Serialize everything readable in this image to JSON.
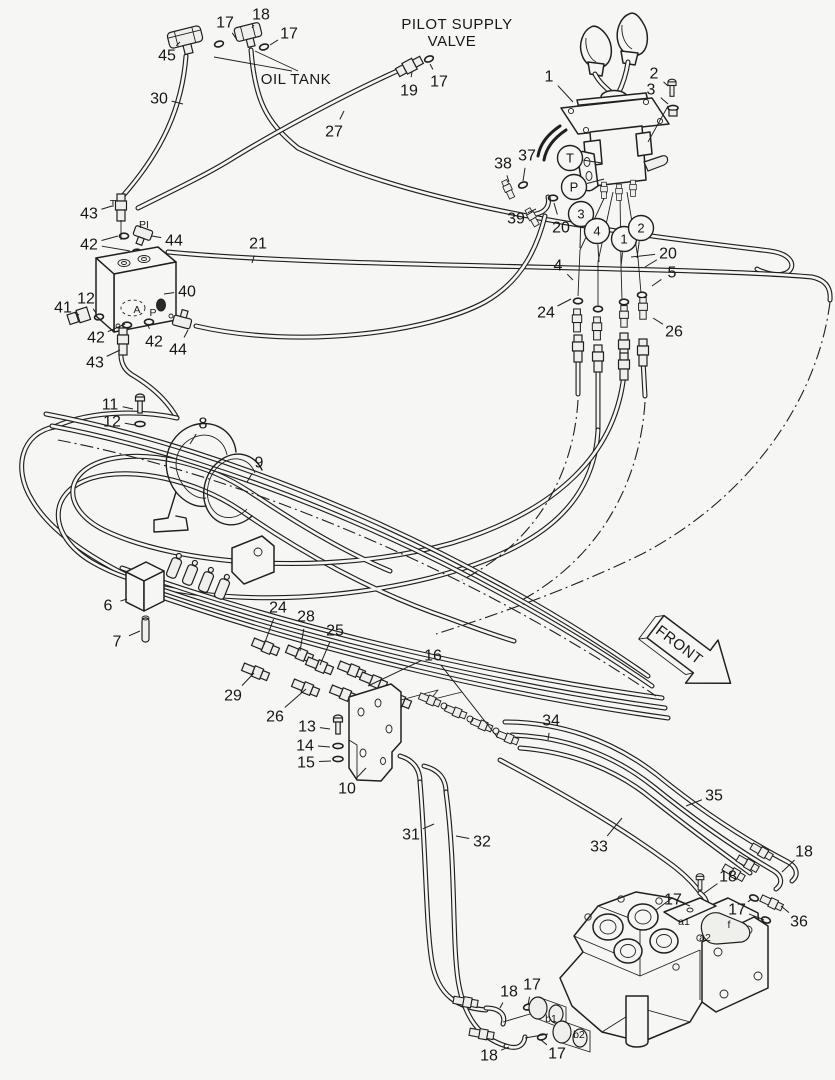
{
  "diagram": {
    "type": "parts-piping-diagram",
    "subject": "Pilot supply valve hose / piping assembly",
    "colors": {
      "line": "#202020",
      "background": "#f6f6f4"
    },
    "labels": {
      "pilot_supply_valve_line1": "PILOT SUPPLY",
      "pilot_supply_valve_line2": "VALVE",
      "oil_tank": "OIL TANK",
      "front": "FRONT"
    },
    "callouts": [
      {
        "t": "17",
        "x": 225,
        "y": 22,
        "lx": 237,
        "ly": 40
      },
      {
        "t": "18",
        "x": 261,
        "y": 14,
        "lx": 252,
        "ly": 28
      },
      {
        "t": "17",
        "x": 289,
        "y": 33,
        "lx": 270,
        "ly": 45
      },
      {
        "t": "45",
        "x": 167,
        "y": 55,
        "lx": 180,
        "ly": 42
      },
      {
        "t": "30",
        "x": 159,
        "y": 98,
        "lx": 183,
        "ly": 104
      },
      {
        "t": "27",
        "x": 334,
        "y": 131,
        "lx": 344,
        "ly": 111
      },
      {
        "t": "19",
        "x": 409,
        "y": 90,
        "lx": 412,
        "ly": 72
      },
      {
        "t": "17",
        "x": 439,
        "y": 81,
        "lx": 430,
        "ly": 64
      },
      {
        "t": "1",
        "x": 549,
        "y": 76,
        "lx": 573,
        "ly": 102
      },
      {
        "t": "2",
        "x": 654,
        "y": 73,
        "lx": 668,
        "ly": 86
      },
      {
        "t": "3",
        "x": 651,
        "y": 89,
        "lx": 668,
        "ly": 104
      },
      {
        "t": "38",
        "x": 503,
        "y": 163,
        "lx": 509,
        "ly": 182
      },
      {
        "t": "37",
        "x": 527,
        "y": 155,
        "lx": 523,
        "ly": 181
      },
      {
        "t": "39",
        "x": 516,
        "y": 218,
        "lx": 536,
        "ly": 209
      },
      {
        "t": "20",
        "x": 561,
        "y": 227,
        "lx": 554,
        "ly": 203
      },
      {
        "t": "20",
        "x": 668,
        "y": 253,
        "lx": 631,
        "ly": 257,
        "l2x": 645,
        "l2y": 267
      },
      {
        "t": "4",
        "x": 558,
        "y": 265,
        "lx": 573,
        "ly": 280
      },
      {
        "t": "5",
        "x": 672,
        "y": 272,
        "lx": 652,
        "ly": 286
      },
      {
        "t": "24",
        "x": 546,
        "y": 312,
        "lx": 571,
        "ly": 299
      },
      {
        "t": "26",
        "x": 674,
        "y": 331,
        "lx": 653,
        "ly": 318
      },
      {
        "t": "43",
        "x": 89,
        "y": 213,
        "lx": 112,
        "ly": 206
      },
      {
        "t": "42",
        "x": 89,
        "y": 244,
        "lx": 118,
        "ly": 236,
        "l2x": 130,
        "l2y": 251
      },
      {
        "t": "44",
        "x": 174,
        "y": 240,
        "lx": 152,
        "ly": 236
      },
      {
        "t": "21",
        "x": 258,
        "y": 243,
        "lx": 252,
        "ly": 263
      },
      {
        "t": "40",
        "x": 187,
        "y": 291,
        "lx": 164,
        "ly": 294
      },
      {
        "t": "41",
        "x": 63,
        "y": 307,
        "lx": 79,
        "ly": 315
      },
      {
        "t": "12",
        "x": 86,
        "y": 298,
        "lx": 96,
        "ly": 313
      },
      {
        "t": "42",
        "x": 96,
        "y": 337,
        "lx": 125,
        "ly": 324
      },
      {
        "t": "42",
        "x": 154,
        "y": 341,
        "lx": 148,
        "ly": 325
      },
      {
        "t": "44",
        "x": 178,
        "y": 349,
        "lx": 188,
        "ly": 330
      },
      {
        "t": "43",
        "x": 95,
        "y": 362,
        "lx": 120,
        "ly": 350
      },
      {
        "t": "11",
        "x": 110,
        "y": 404,
        "lx": 133,
        "ly": 409
      },
      {
        "t": "12",
        "x": 112,
        "y": 421,
        "lx": 135,
        "ly": 425
      },
      {
        "t": "8",
        "x": 203,
        "y": 423,
        "lx": 190,
        "ly": 444
      },
      {
        "t": "9",
        "x": 259,
        "y": 462,
        "lx": 247,
        "ly": 482
      },
      {
        "t": "6",
        "x": 108,
        "y": 605,
        "lx": 127,
        "ly": 599
      },
      {
        "t": "7",
        "x": 117,
        "y": 641,
        "lx": 140,
        "ly": 631
      },
      {
        "t": "24",
        "x": 278,
        "y": 607,
        "lx": 264,
        "ly": 645
      },
      {
        "t": "28",
        "x": 306,
        "y": 616,
        "lx": 300,
        "ly": 651
      },
      {
        "t": "25",
        "x": 335,
        "y": 630,
        "lx": 320,
        "ly": 665
      },
      {
        "t": "29",
        "x": 233,
        "y": 695,
        "lx": 254,
        "ly": 673
      },
      {
        "t": "26",
        "x": 275,
        "y": 716,
        "lx": 306,
        "ly": 689
      },
      {
        "t": "13",
        "x": 307,
        "y": 726,
        "lx": 330,
        "ly": 729
      },
      {
        "t": "14",
        "x": 305,
        "y": 745,
        "lx": 330,
        "ly": 747
      },
      {
        "t": "15",
        "x": 306,
        "y": 762,
        "lx": 331,
        "ly": 761
      },
      {
        "t": "10",
        "x": 347,
        "y": 788,
        "lx": 366,
        "ly": 768
      },
      {
        "t": "16",
        "x": 433,
        "y": 655,
        "lx": 368,
        "ly": 686,
        "l2x": 498,
        "l2y": 738
      },
      {
        "t": "34",
        "x": 551,
        "y": 720,
        "lx": 548,
        "ly": 740
      },
      {
        "t": "31",
        "x": 411,
        "y": 834,
        "lx": 434,
        "ly": 824
      },
      {
        "t": "32",
        "x": 482,
        "y": 841,
        "lx": 456,
        "ly": 836
      },
      {
        "t": "33",
        "x": 599,
        "y": 846,
        "lx": 622,
        "ly": 818
      },
      {
        "t": "35",
        "x": 714,
        "y": 795,
        "lx": 686,
        "ly": 806
      },
      {
        "t": "18",
        "x": 804,
        "y": 851,
        "lx": 782,
        "ly": 872
      },
      {
        "t": "18",
        "x": 728,
        "y": 876,
        "lx": 703,
        "ly": 894
      },
      {
        "t": "17",
        "x": 673,
        "y": 899,
        "lx": 690,
        "ly": 906
      },
      {
        "t": "17",
        "x": 737,
        "y": 909,
        "lx": 752,
        "ly": 899,
        "l2x": 764,
        "l2y": 920
      },
      {
        "t": "36",
        "x": 799,
        "y": 921,
        "lx": 781,
        "ly": 906
      },
      {
        "t": "18",
        "x": 509,
        "y": 991,
        "lx": 500,
        "ly": 1008
      },
      {
        "t": "17",
        "x": 532,
        "y": 984,
        "lx": 528,
        "ly": 1005
      },
      {
        "t": "18",
        "x": 489,
        "y": 1055,
        "lx": 509,
        "ly": 1047
      },
      {
        "t": "17",
        "x": 557,
        "y": 1053,
        "lx": 541,
        "ly": 1040
      }
    ],
    "circled_callouts": [
      {
        "t": "T",
        "x": 570,
        "y": 158,
        "lx": 602,
        "ly": 163
      },
      {
        "t": "P",
        "x": 574,
        "y": 187,
        "lx": 604,
        "ly": 179
      },
      {
        "t": "3",
        "x": 581,
        "y": 214,
        "lx": 580,
        "ly": 248
      },
      {
        "t": "4",
        "x": 597,
        "y": 231,
        "lx": 599,
        "ly": 262
      },
      {
        "t": "1",
        "x": 624,
        "y": 239,
        "lx": 621,
        "ly": 266
      },
      {
        "t": "2",
        "x": 641,
        "y": 228,
        "lx": 637,
        "ly": 258
      }
    ],
    "port_labels": [
      {
        "t": "T",
        "x": 113,
        "y": 207
      },
      {
        "t": "PI",
        "x": 144,
        "y": 228
      },
      {
        "t": "A",
        "x": 137,
        "y": 313
      },
      {
        "t": "P",
        "x": 153,
        "y": 316
      },
      {
        "t": "a1",
        "x": 684,
        "y": 925
      },
      {
        "t": "a2",
        "x": 705,
        "y": 941
      },
      {
        "t": "f",
        "x": 729,
        "y": 928
      },
      {
        "t": "b1",
        "x": 551,
        "y": 1022
      },
      {
        "t": "b2",
        "x": 579,
        "y": 1038
      }
    ]
  }
}
